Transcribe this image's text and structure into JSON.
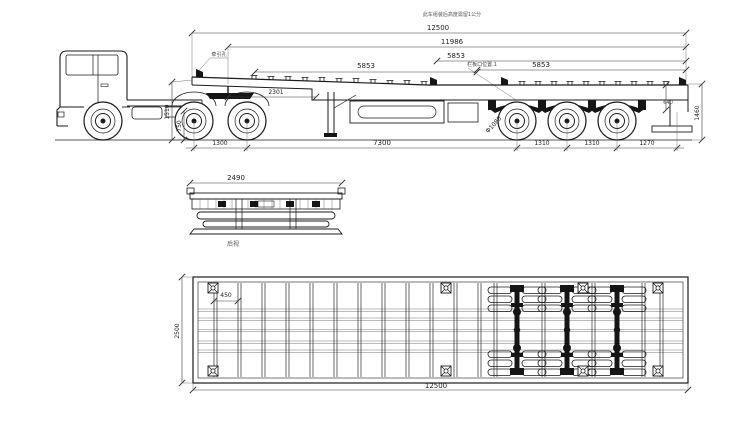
{
  "note": "此车组装后高度需留1公分",
  "side_view": {
    "overall_length": "12500",
    "frame_length": "11986",
    "span_front": "5853",
    "span_mid": "5853",
    "span_rear": "5853",
    "kingpin_label": "牵引孔",
    "panel_note": "栏板口位置.1",
    "kingpin_to_landing": "2301",
    "deck_height": "1510",
    "frame_height": "750",
    "rear_step": "640",
    "rear_height": "1460",
    "tire_dia": "Φ1080",
    "tractor_axle_gap": "1300",
    "wheelbase": "7300",
    "axle_gap_1": "1310",
    "axle_gap_2": "1310",
    "rear_overhang": "1270"
  },
  "rear_view": {
    "width": "2490",
    "caption": "后视"
  },
  "plan_view": {
    "crossmember_pitch": "450",
    "overall_width": "2500",
    "overall_length": "12500"
  }
}
